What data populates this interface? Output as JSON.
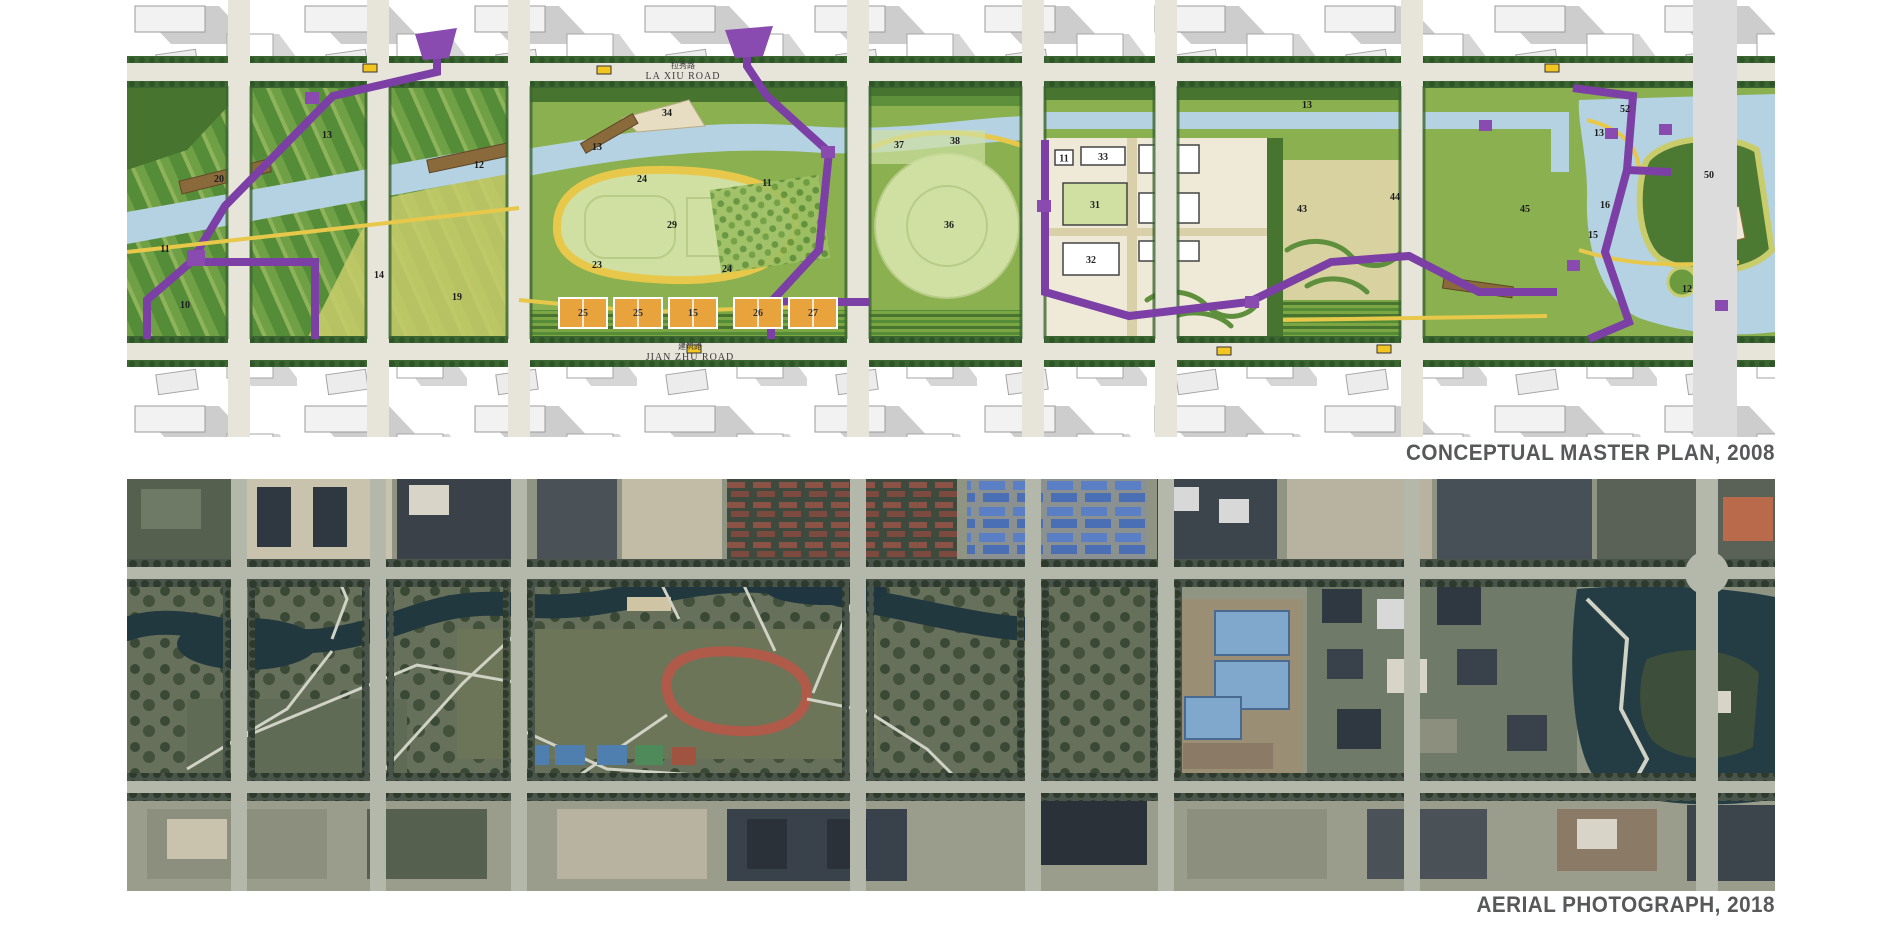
{
  "figure": {
    "caption_color": "#57585a",
    "panels": [
      {
        "id": "master-plan",
        "caption": "CONCEPTUAL MASTER PLAN, 2008"
      },
      {
        "id": "aerial-photo",
        "caption": "AERIAL PHOTOGRAPH, 2018"
      }
    ]
  },
  "master_plan": {
    "roads": [
      {
        "name_zh": "拉秀路",
        "name_en": "LA XIU ROAD"
      },
      {
        "name_zh": "建筑路",
        "name_en": "JIAN ZHU ROAD"
      }
    ],
    "colors": {
      "purple_path": "#7b3fa6",
      "water": "#b5d2e2",
      "lawn": "#cfe0a2",
      "park_green": "#7ca544",
      "tree_dark": "#47742f",
      "meadow_yellow": "#c9cc6b",
      "path_yellow": "#e8c84a",
      "court_orange": "#e8a33d",
      "deck_brown": "#8a6a3b",
      "building_gray": "#cfcfcf",
      "road_gray": "#e7e4da"
    },
    "courts": [
      {
        "label": "25",
        "x": 432
      },
      {
        "label": "25",
        "x": 487
      },
      {
        "label": "15",
        "x": 542
      },
      {
        "label": "26",
        "x": 607
      },
      {
        "label": "27",
        "x": 662
      }
    ],
    "buildings": [
      {
        "n": "11",
        "x": 928,
        "y": 150,
        "w": 18,
        "h": 15,
        "green": false
      },
      {
        "n": "33",
        "x": 954,
        "y": 147,
        "w": 44,
        "h": 18,
        "green": false
      },
      {
        "n": "15",
        "x": 1012,
        "y": 145,
        "w": 60,
        "h": 28,
        "green": false
      },
      {
        "n": "31",
        "x": 936,
        "y": 183,
        "w": 64,
        "h": 42,
        "green": true
      },
      {
        "n": "22",
        "x": 1012,
        "y": 193,
        "w": 60,
        "h": 30,
        "green": false
      },
      {
        "n": "32",
        "x": 936,
        "y": 243,
        "w": 56,
        "h": 32,
        "green": false
      },
      {
        "n": "42",
        "x": 1012,
        "y": 241,
        "w": 60,
        "h": 20,
        "green": false
      }
    ],
    "number_labels": [
      {
        "n": "10",
        "x": 58,
        "y": 308
      },
      {
        "n": "11",
        "x": 38,
        "y": 252
      },
      {
        "n": "13",
        "x": 200,
        "y": 138
      },
      {
        "n": "20",
        "x": 92,
        "y": 182
      },
      {
        "n": "12",
        "x": 352,
        "y": 168
      },
      {
        "n": "14",
        "x": 252,
        "y": 278
      },
      {
        "n": "19",
        "x": 330,
        "y": 300
      },
      {
        "n": "34",
        "x": 540,
        "y": 116
      },
      {
        "n": "13",
        "x": 470,
        "y": 150
      },
      {
        "n": "11",
        "x": 640,
        "y": 186
      },
      {
        "n": "24",
        "x": 515,
        "y": 182
      },
      {
        "n": "29",
        "x": 545,
        "y": 228
      },
      {
        "n": "23",
        "x": 470,
        "y": 268
      },
      {
        "n": "24",
        "x": 600,
        "y": 272
      },
      {
        "n": "37",
        "x": 772,
        "y": 148
      },
      {
        "n": "38",
        "x": 828,
        "y": 144
      },
      {
        "n": "36",
        "x": 822,
        "y": 228
      },
      {
        "n": "13",
        "x": 1180,
        "y": 108
      },
      {
        "n": "43",
        "x": 1175,
        "y": 212
      },
      {
        "n": "44",
        "x": 1268,
        "y": 200
      },
      {
        "n": "45",
        "x": 1398,
        "y": 212
      },
      {
        "n": "52",
        "x": 1498,
        "y": 112
      },
      {
        "n": "13",
        "x": 1472,
        "y": 136
      },
      {
        "n": "50",
        "x": 1582,
        "y": 178
      },
      {
        "n": "16",
        "x": 1478,
        "y": 208
      },
      {
        "n": "15",
        "x": 1466,
        "y": 238
      },
      {
        "n": "12",
        "x": 1560,
        "y": 292
      }
    ]
  },
  "aerial": {
    "features": [
      "winding-river",
      "park-lawns",
      "red-running-track",
      "tree-lined-roads",
      "red-roof-residential-blocks",
      "blue-roof-warehouses",
      "blue-pools-in-dirt-lot",
      "sports-courts",
      "lake-with-wooded-island",
      "dense-city-blocks",
      "construction-sites"
    ]
  }
}
